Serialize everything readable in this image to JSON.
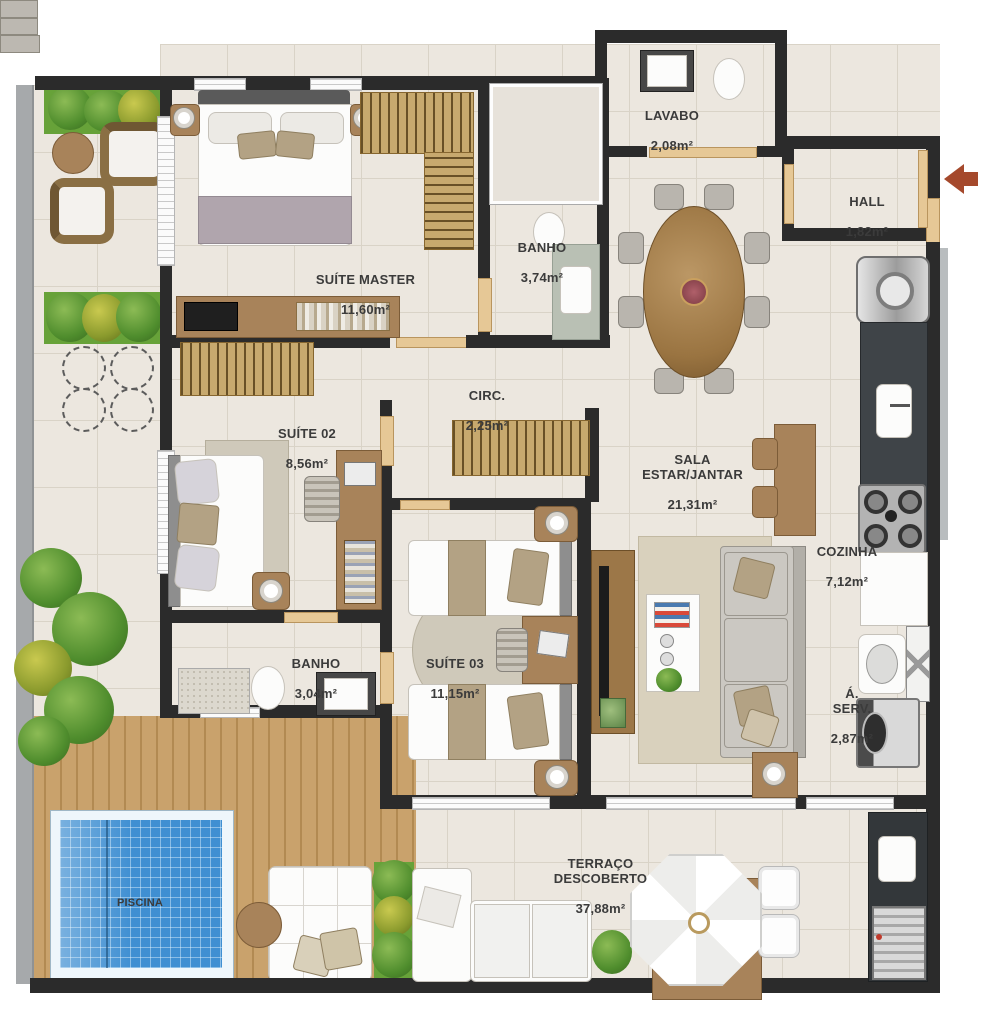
{
  "plan": {
    "type": "apartment-floor-plan",
    "rooms": {
      "suite_master": {
        "name": "SUÍTE MASTER",
        "area": "11,60m²"
      },
      "banho_suite": {
        "name": "BANHO",
        "area": "3,74m²"
      },
      "lavabo": {
        "name": "LAVABO",
        "area": "2,08m²"
      },
      "hall": {
        "name": "HALL",
        "area": "1,82m²"
      },
      "circ": {
        "name": "CIRC.",
        "area": "2,25m²"
      },
      "suite_02": {
        "name": "SUÍTE 02",
        "area": "8,56m²"
      },
      "sala": {
        "name": "SALA\nESTAR/JANTAR",
        "area": "21,31m²"
      },
      "cozinha": {
        "name": "COZINHA",
        "area": "7,12m²"
      },
      "banho_02": {
        "name": "BANHO",
        "area": "3,04m²"
      },
      "suite_03": {
        "name": "SUÍTE 03",
        "area": "11,15m²"
      },
      "area_servico": {
        "name": "Á.\nSERV.",
        "area": "2,87m²"
      },
      "terraco": {
        "name": "TERRAÇO\nDESCOBERTO",
        "area": "37,88m²"
      },
      "piscina": {
        "name": "PISCINA",
        "area": ""
      }
    },
    "colors": {
      "wall": "#2b2b2b",
      "tile": "#ece7df",
      "tile_line": "#d9d3c7",
      "wood": "#a8835a",
      "deck": "#c59d66",
      "pool_water": "#3f8fd2",
      "grass": "#67a239",
      "door_frame": "#e6c896",
      "counter_dark": "#3f4448",
      "entry_arrow": "#a5492c",
      "label_text": "#3b3b3b"
    }
  }
}
